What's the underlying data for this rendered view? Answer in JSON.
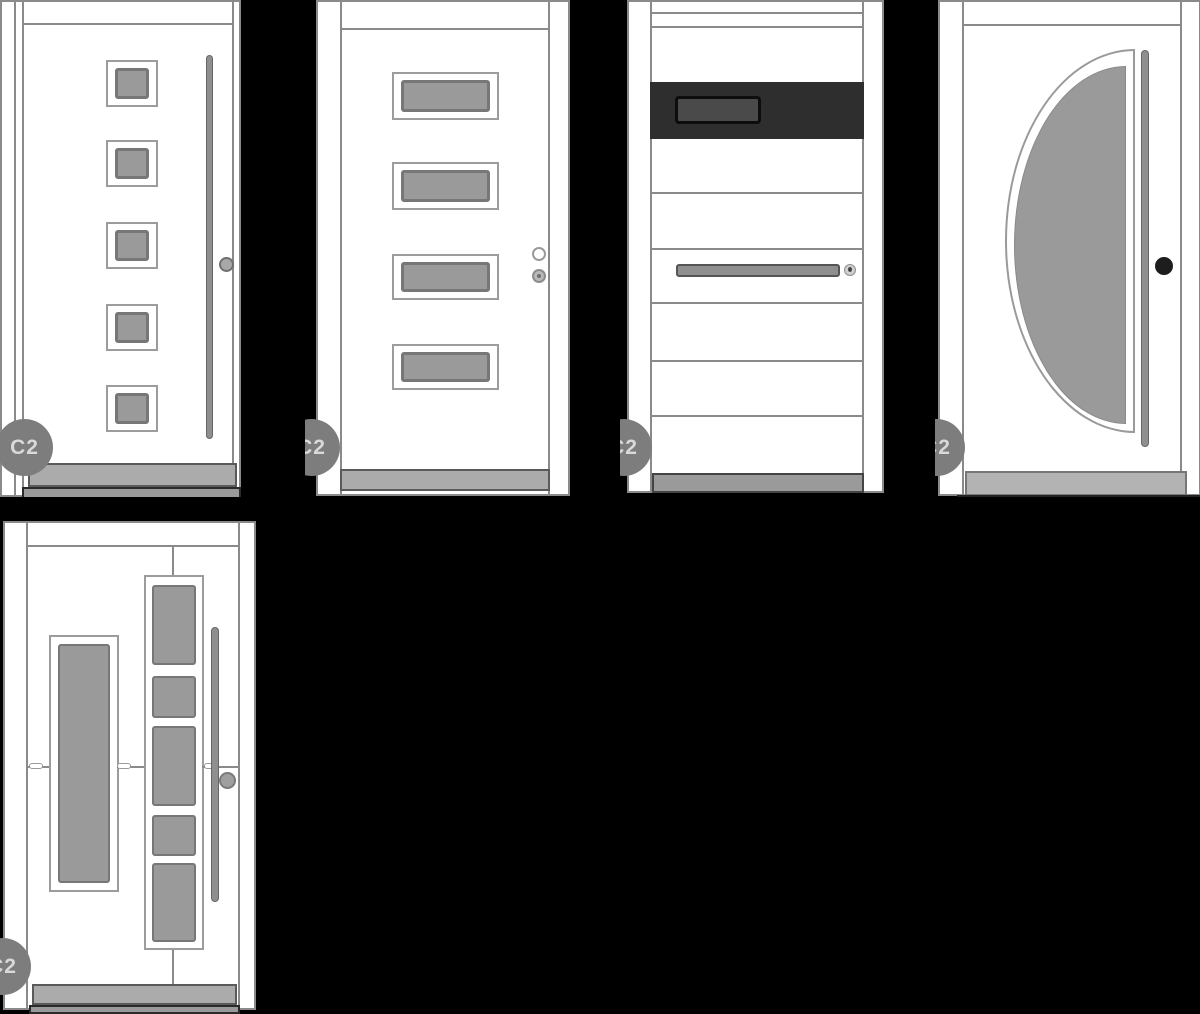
{
  "background_color": "#000000",
  "watermark": {
    "label": "C2"
  },
  "colors": {
    "bg": "#000000",
    "door_fill": "#ffffff",
    "door_line": "#8a8a8a",
    "glass": "#9a9a9a",
    "glass_frame": "#777777",
    "band": "#2e2e2e",
    "band_inset": "#4a4a4a",
    "band_inset_border": "#0d0d0d",
    "handle": "#8f8f8f",
    "handle_border": "#666666",
    "knob_dark": "#1d1d1d",
    "threshold": "#ababab",
    "threshold_border": "#5a5a5a",
    "strip": "#9a9a9a",
    "strip_border": "#2a2a2a",
    "watermark_bg": "#7d7d7d",
    "watermark_text": "#d9d9d9"
  },
  "doors": [
    {
      "id": "door-1",
      "style": "five-square-windows-vertical-bar-handle",
      "watermark": "C2"
    },
    {
      "id": "door-2",
      "style": "four-horizontal-windows-knob-and-lock",
      "watermark": "C2"
    },
    {
      "id": "door-3",
      "style": "dark-glass-band-horizontal-grooves-bar-handle",
      "watermark": "C2"
    },
    {
      "id": "door-4",
      "style": "half-moon-glass-vertical-bar-handle",
      "watermark": "C2"
    },
    {
      "id": "door-5",
      "style": "vertical-glass-panel-columns-bar-handle",
      "watermark": "C2"
    }
  ]
}
